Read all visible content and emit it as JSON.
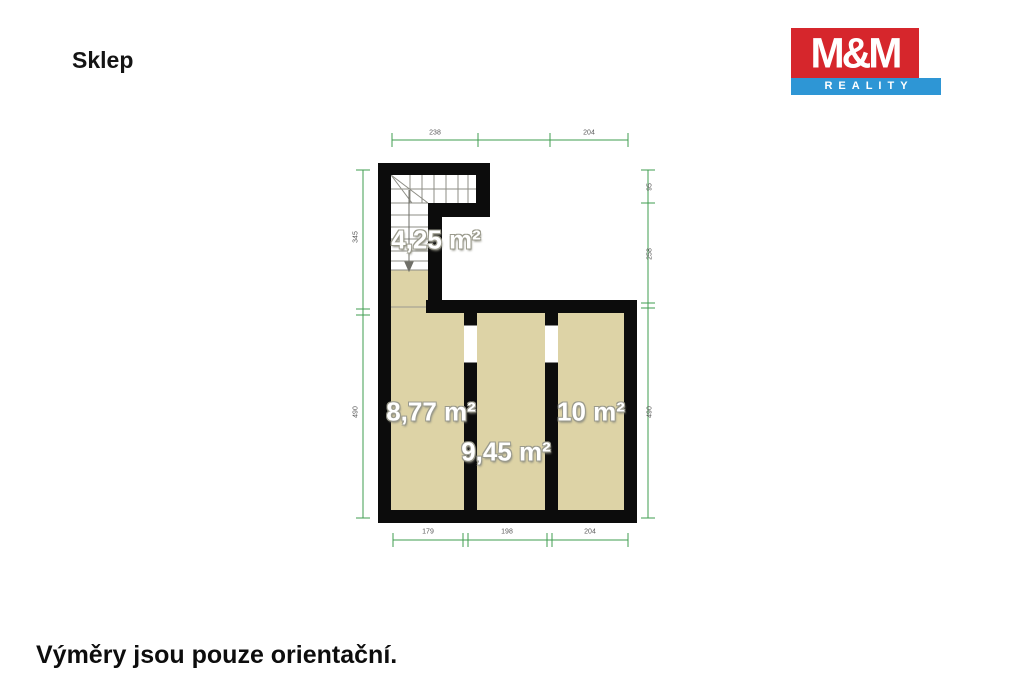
{
  "page": {
    "title": "Sklep",
    "footer": "Výměry jsou pouze orientační."
  },
  "logo": {
    "top_text": "M&M",
    "bottom_text": "REALITY",
    "red": "#d6262c",
    "blue": "#2e96d5"
  },
  "plan": {
    "wall_color": "#0c0c0c",
    "room_fill": "#ddd3a6",
    "dimension_color": "#3f9d4f",
    "rooms": [
      {
        "name": "staircase",
        "area_label": "4,25 m²"
      },
      {
        "name": "room-left",
        "area_label": "8,77 m²"
      },
      {
        "name": "room-middle",
        "area_label": "9,45 m²"
      },
      {
        "name": "room-right",
        "area_label": "10 m²"
      }
    ],
    "dimensions": {
      "top": [
        "238",
        "204"
      ],
      "bottom": [
        "179",
        "198",
        "204"
      ],
      "left": [
        "345",
        "490"
      ],
      "right": [
        "95",
        "258",
        "490"
      ]
    }
  }
}
